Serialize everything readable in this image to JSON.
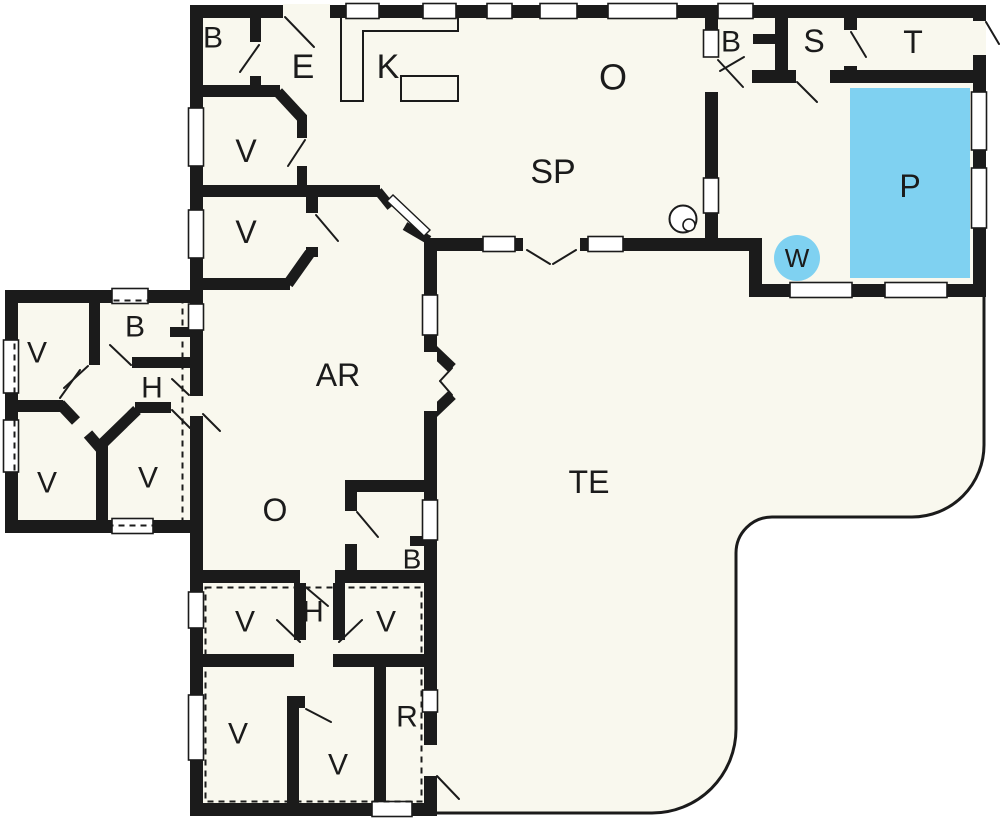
{
  "plan": {
    "title": "Holiday house floor plan",
    "colors": {
      "background": "#ffffff",
      "floor": "#f9f8ee",
      "wall": "#1b1b1b",
      "water": "#7fd1f1",
      "label": "#1b1b1b"
    },
    "fixtures": {
      "pool": "pool-basin",
      "whirlpool": "whirlpool-tub",
      "stove": "wood-stove",
      "kitchen_counter": "kitchen-counter",
      "kitchen_island": "kitchen-island",
      "extension_outline": "dashed-extension-boundary",
      "terrace_edge": "terrace-boundary-line"
    },
    "rooms": [
      {
        "id": "bath-top-left",
        "label": "B",
        "x": 213,
        "y": 38,
        "fs": 30
      },
      {
        "id": "entry",
        "label": "E",
        "x": 303,
        "y": 67,
        "fs": 34
      },
      {
        "id": "kitchen",
        "label": "K",
        "x": 388,
        "y": 67,
        "fs": 34
      },
      {
        "id": "living",
        "label": "O",
        "x": 613,
        "y": 77,
        "fs": 36
      },
      {
        "id": "dining",
        "label": "SP",
        "x": 553,
        "y": 172,
        "fs": 34
      },
      {
        "id": "bath-top-right",
        "label": "B",
        "x": 731,
        "y": 42,
        "fs": 30
      },
      {
        "id": "sauna",
        "label": "S",
        "x": 814,
        "y": 41,
        "fs": 32
      },
      {
        "id": "toilet-right",
        "label": "T",
        "x": 913,
        "y": 42,
        "fs": 32
      },
      {
        "id": "pool",
        "label": "P",
        "x": 910,
        "y": 186,
        "fs": 32
      },
      {
        "id": "whirlpool",
        "label": "W",
        "x": 797,
        "y": 258,
        "fs": 26
      },
      {
        "id": "bedroom-main-1",
        "label": "V",
        "x": 246,
        "y": 151,
        "fs": 32
      },
      {
        "id": "bedroom-main-2",
        "label": "V",
        "x": 246,
        "y": 232,
        "fs": 32
      },
      {
        "id": "activity-room",
        "label": "AR",
        "x": 338,
        "y": 375,
        "fs": 32
      },
      {
        "id": "bedroom-annex-tl",
        "label": "V",
        "x": 37,
        "y": 353,
        "fs": 30
      },
      {
        "id": "bath-annex",
        "label": "B",
        "x": 135,
        "y": 327,
        "fs": 30
      },
      {
        "id": "hall-annex",
        "label": "H",
        "x": 152,
        "y": 388,
        "fs": 30
      },
      {
        "id": "bedroom-annex-bl",
        "label": "V",
        "x": 47,
        "y": 483,
        "fs": 30
      },
      {
        "id": "bedroom-annex-br",
        "label": "V",
        "x": 148,
        "y": 478,
        "fs": 30
      },
      {
        "id": "lounge-lower",
        "label": "O",
        "x": 275,
        "y": 510,
        "fs": 32
      },
      {
        "id": "bath-mid",
        "label": "B",
        "x": 412,
        "y": 559,
        "fs": 28
      },
      {
        "id": "terrace",
        "label": "TE",
        "x": 589,
        "y": 482,
        "fs": 32
      },
      {
        "id": "bedroom-wing-tl",
        "label": "V",
        "x": 245,
        "y": 622,
        "fs": 30
      },
      {
        "id": "hall-wing",
        "label": "H",
        "x": 313,
        "y": 612,
        "fs": 30
      },
      {
        "id": "bedroom-wing-tr",
        "label": "V",
        "x": 386,
        "y": 622,
        "fs": 30
      },
      {
        "id": "bedroom-wing-bl",
        "label": "V",
        "x": 238,
        "y": 734,
        "fs": 30
      },
      {
        "id": "bedroom-wing-bc",
        "label": "V",
        "x": 338,
        "y": 765,
        "fs": 30
      },
      {
        "id": "storage",
        "label": "R",
        "x": 407,
        "y": 717,
        "fs": 30
      }
    ]
  }
}
